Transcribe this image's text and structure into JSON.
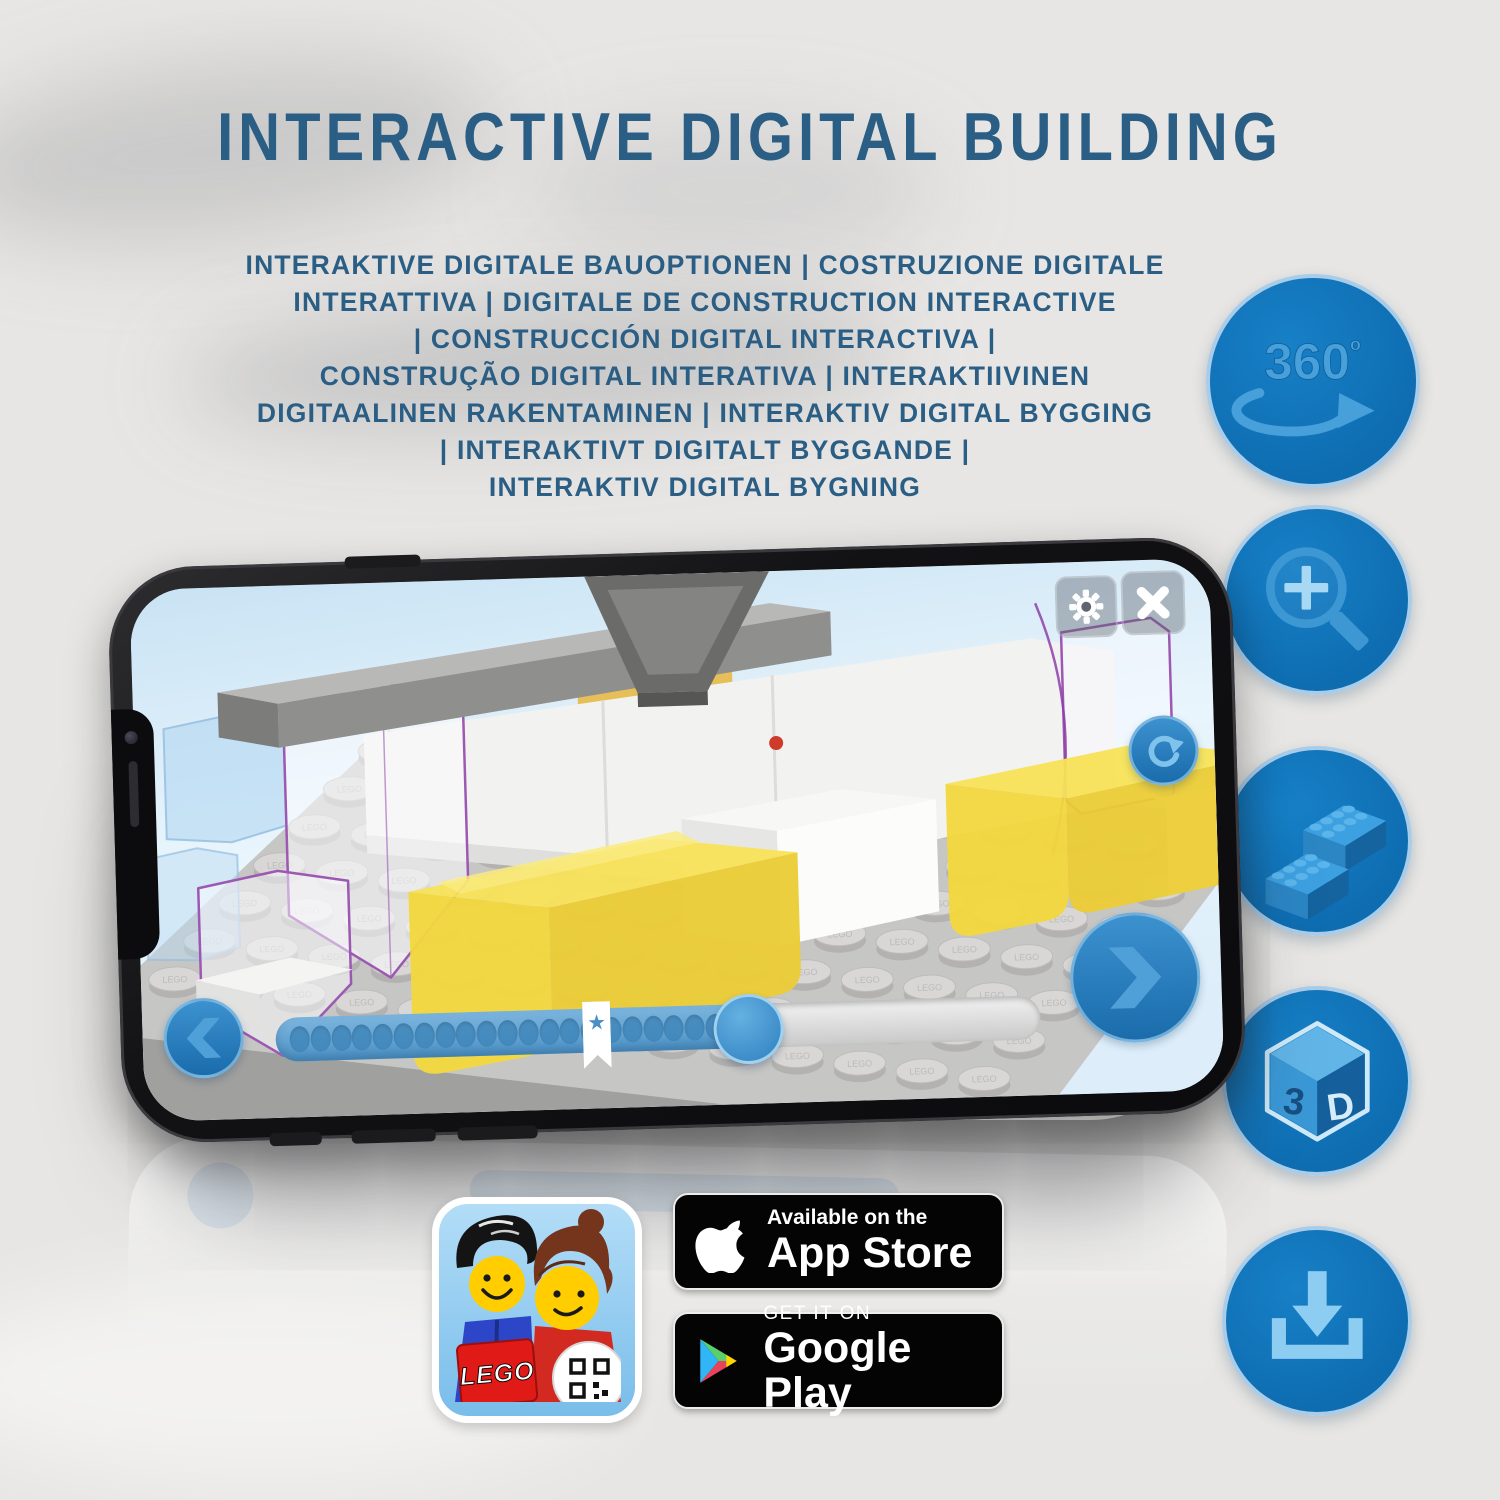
{
  "title": "INTERACTIVE DIGITAL BUILDING",
  "subtitle_lines": [
    "INTERAKTIVE DIGITALE BAUOPTIONEN | COSTRUZIONE DIGITALE",
    "INTERATTIVA | DIGITALE DE CONSTRUCTION INTERACTIVE",
    "| CONSTRUCCIÓN DIGITAL INTERACTIVA |",
    "CONSTRUÇÃO DIGITAL INTERATIVA | INTERAKTIIVINEN",
    "DIGITAALINEN RAKENTAMINEN | INTERAKTIV DIGITAL BYGGING",
    "| INTERAKTIVT DIGITALT BYGGANDE |",
    "INTERAKTIV DIGITAL BYGNING"
  ],
  "side_icons": [
    {
      "name": "360-rotation",
      "label": "360",
      "label_sup": "º"
    },
    {
      "name": "zoom-magnifier"
    },
    {
      "name": "brick-options"
    },
    {
      "name": "3d-view",
      "left": "3",
      "right": "D"
    },
    {
      "name": "download"
    }
  ],
  "phone_app": {
    "stud_label": "LEGO",
    "progress": {
      "total_dots": 21,
      "filled_percent": 62,
      "star_percent": 42,
      "star_glyph": "★"
    }
  },
  "badges": {
    "lego_logo": "LEGO",
    "app_store": {
      "top": "Available on the",
      "bottom": "App Store"
    },
    "google_play": {
      "top": "GET IT ON",
      "bottom": "Google Play"
    }
  },
  "colors": {
    "heading_blue": "#2b5e84",
    "icon_circle": "#0f72b9",
    "icon_rim": "#a9cce9",
    "icon_glyph": "#47a0da",
    "progress_fill": "#4e93c7",
    "yellow_brick": "#f4d83e"
  }
}
